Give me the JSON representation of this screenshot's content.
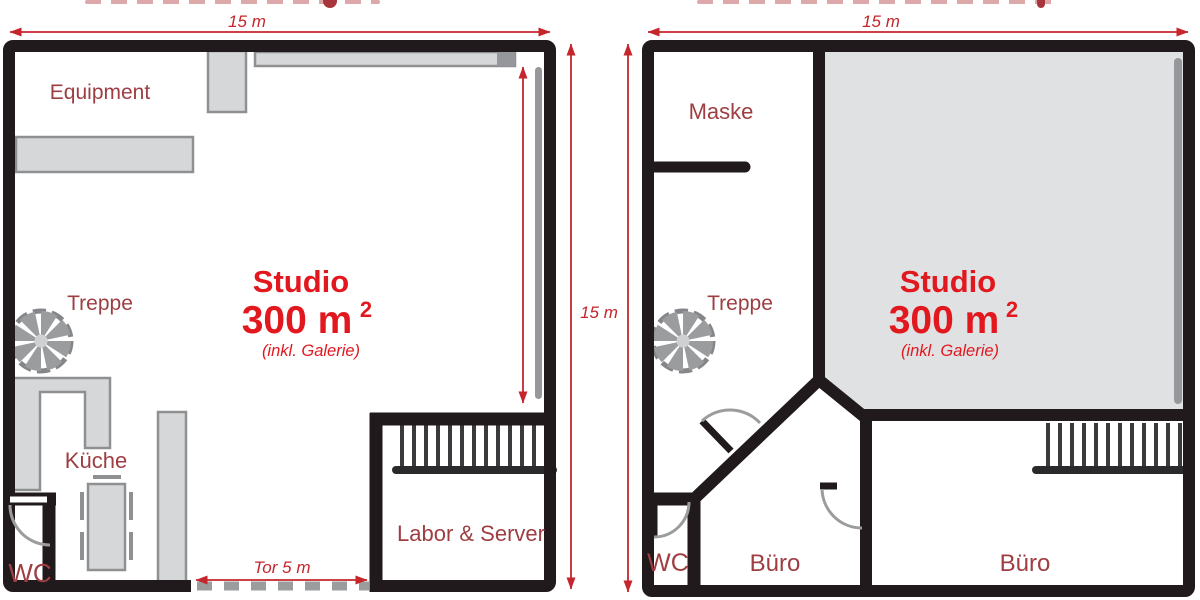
{
  "colors": {
    "wall": "#211a1c",
    "furniture_fill": "#d6d7d9",
    "furniture_border": "#8f9092",
    "studio_fill": "#e0e1e3",
    "room_label_red": "#9e3e42",
    "studio_red": "#e2181f",
    "dimension_red": "#c4262c"
  },
  "plans": [
    {
      "name": "ground-floor-plan",
      "dims": {
        "width": "15 m",
        "height": "15 m",
        "gate": "Tor 5 m"
      },
      "rooms": {
        "equipment": "Equipment",
        "treppe": "Treppe",
        "kueche": "Küche",
        "wc": "WC",
        "labor": "Labor & Server"
      },
      "studio": {
        "name": "Studio",
        "area": "300 m",
        "area_sup": "2",
        "note": "(inkl. Galerie)"
      }
    },
    {
      "name": "upper-floor-plan",
      "dims": {
        "width": "15 m"
      },
      "rooms": {
        "maske": "Maske",
        "treppe": "Treppe",
        "wc": "WC",
        "buero_1": "Büro",
        "buero_2": "Büro"
      },
      "studio": {
        "name": "Studio",
        "area": "300 m",
        "area_sup": "2",
        "note": "(inkl. Galerie)"
      }
    }
  ]
}
